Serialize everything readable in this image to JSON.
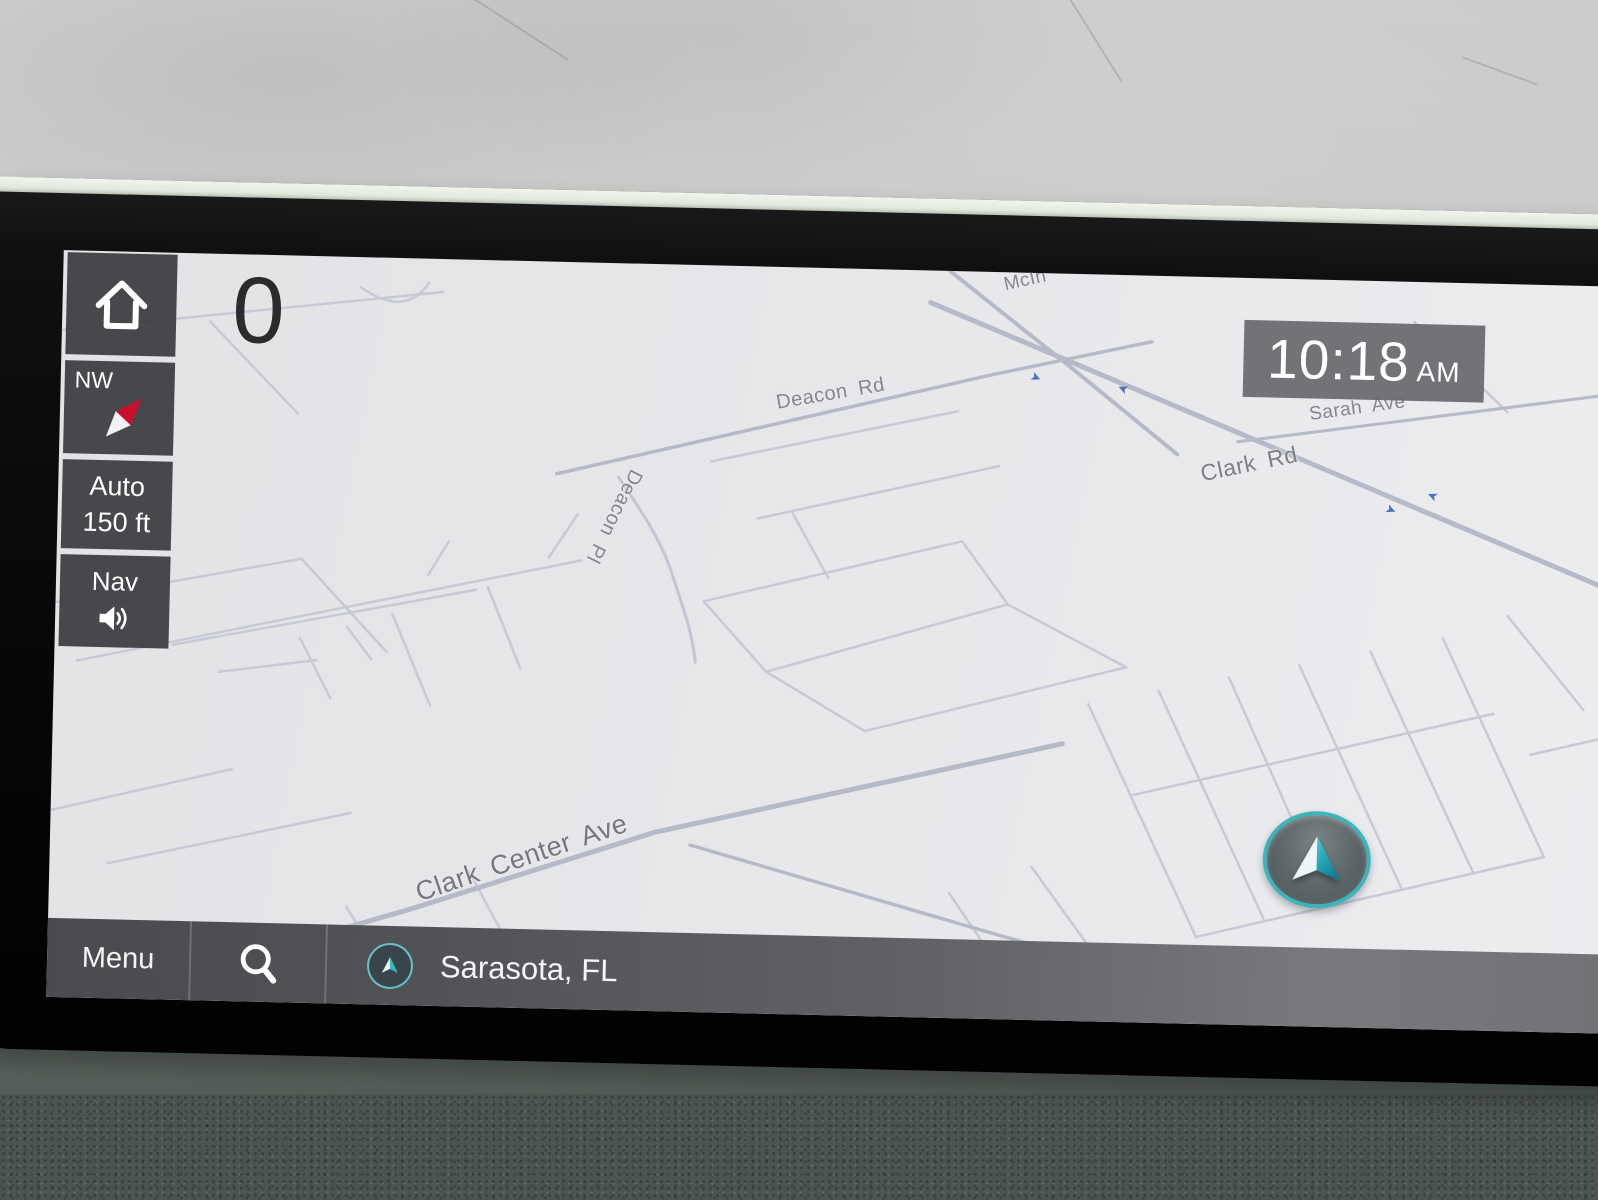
{
  "colors": {
    "accent_teal": "#3db4ba",
    "ui_gray": "#4a4b4f",
    "map_background": "#e8e8eb",
    "road_gray": "#c5c9d4",
    "label_gray": "#83868f",
    "traffic_arrow_blue": "#4a72c0",
    "bezel_black": "#0a0a0a"
  },
  "icons": {
    "home": "house-outline",
    "compass": "compass-needle",
    "volume": "speaker-with-waves",
    "search": "magnifier",
    "location": "nav-arrow-in-circle",
    "vehicle": "nav-arrow-in-circle",
    "traffic_arrow": "➤"
  },
  "screen": {
    "speed": "0",
    "clock": {
      "time": "10:18",
      "period": "AM"
    },
    "sidebar": {
      "compass_heading": "NW",
      "zoom_mode": "Auto",
      "zoom_scale": "150 ft",
      "volume_label": "Nav"
    },
    "bottom_bar": {
      "menu": "Menu",
      "location": "Sarasota, FL"
    },
    "map": {
      "labels": [
        {
          "text": "Deacon Rd"
        },
        {
          "text": "Deacon Pl"
        },
        {
          "text": "McIn"
        },
        {
          "text": "Sarah Ave"
        },
        {
          "text": "Clark Rd"
        },
        {
          "text": "Clark Center Ave"
        }
      ]
    }
  }
}
